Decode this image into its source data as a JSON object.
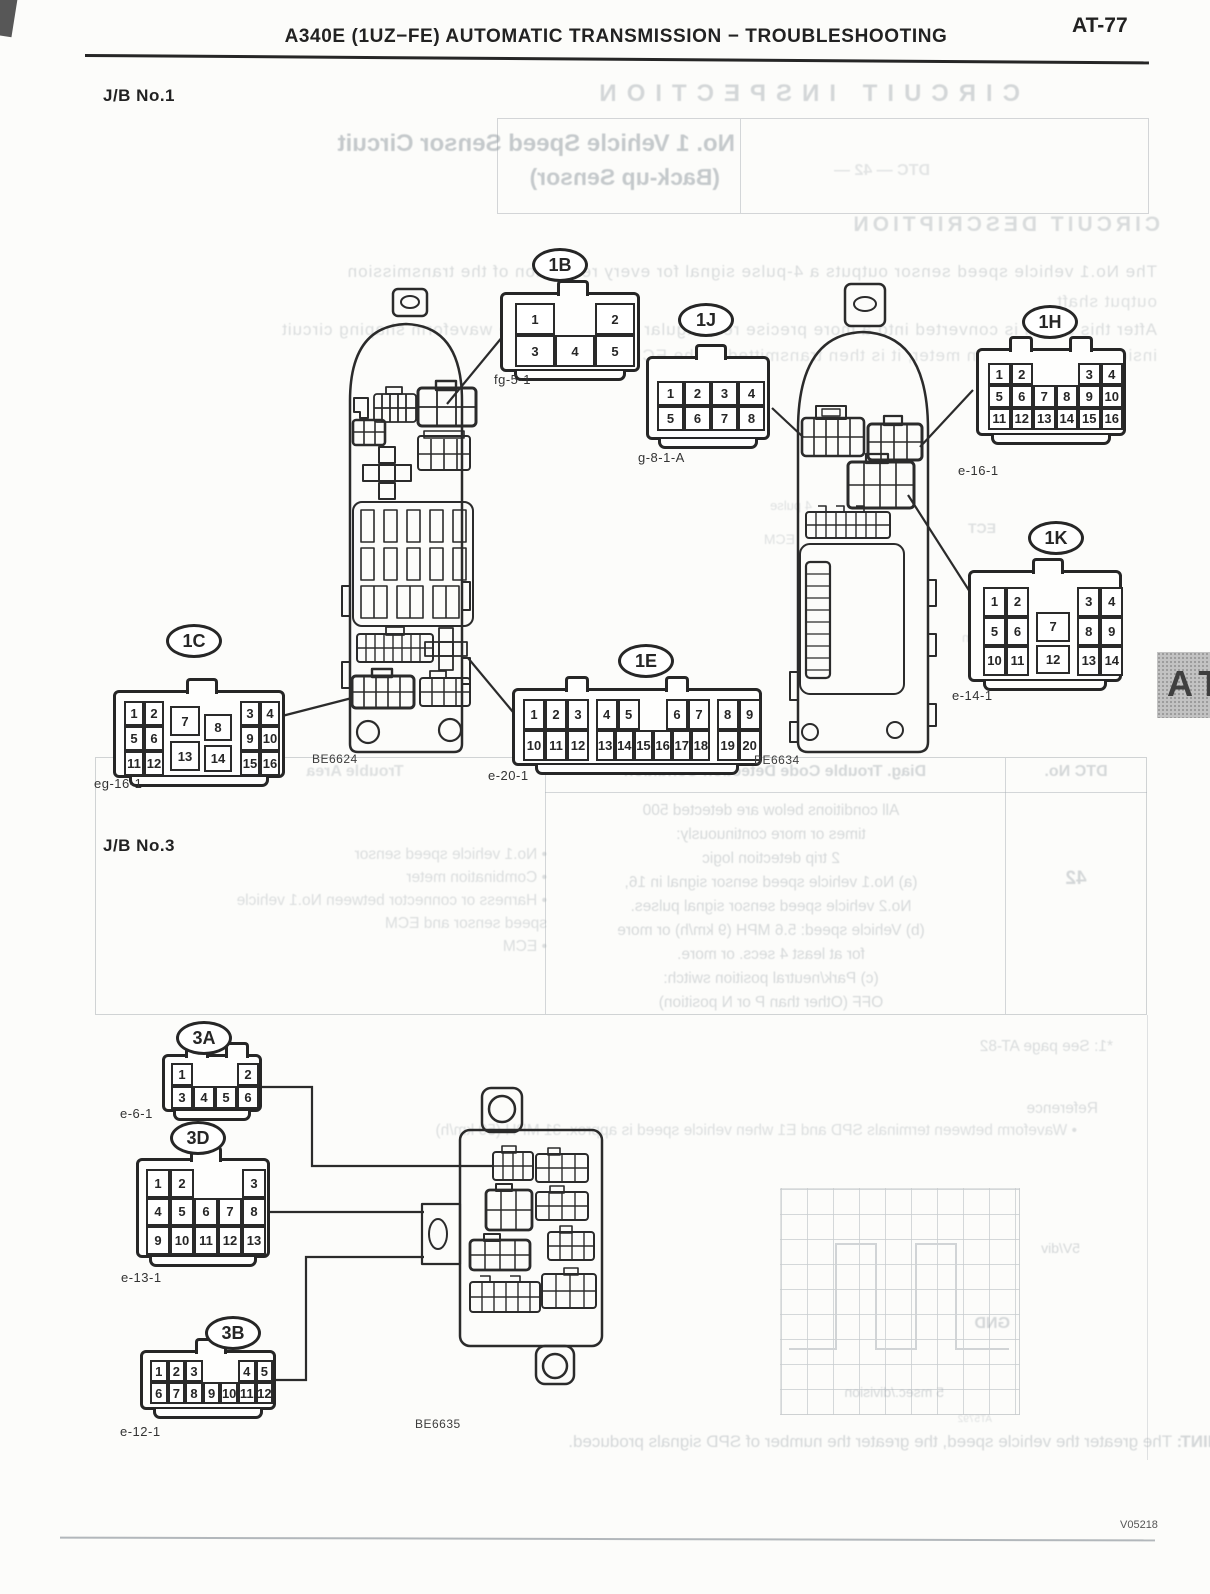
{
  "page": {
    "header_title": "A340E (1UZ−FE) AUTOMATIC TRANSMISSION − TROUBLESHOOTING",
    "page_number": "AT-77",
    "figure_code": "V05218",
    "side_tab": "AT"
  },
  "sections": {
    "jb1_heading": "J/B No.1",
    "jb3_heading": "J/B No.3"
  },
  "junction_blocks": [
    {
      "code": "BE6624"
    },
    {
      "code": "BE6634"
    },
    {
      "code": "BE6635"
    }
  ],
  "connectors": [
    {
      "id": "1B",
      "sublabel": "fg-5-1",
      "cells": [
        [
          "1",
          0,
          0
        ],
        [
          "2",
          2,
          0
        ],
        [
          "3",
          0,
          1
        ],
        [
          "4",
          1,
          1
        ],
        [
          "5",
          2,
          1
        ]
      ]
    },
    {
      "id": "1J",
      "sublabel": "g-8-1-A",
      "cells": [
        [
          "1",
          0,
          0
        ],
        [
          "2",
          1,
          0
        ],
        [
          "3",
          2,
          0
        ],
        [
          "4",
          3,
          0
        ],
        [
          "5",
          0,
          1
        ],
        [
          "6",
          1,
          1
        ],
        [
          "7",
          2,
          1
        ],
        [
          "8",
          3,
          1
        ]
      ]
    },
    {
      "id": "1H",
      "sublabel": "e-16-1",
      "cells": [
        [
          "1",
          0,
          0
        ],
        [
          "2",
          1,
          0
        ],
        [
          "3",
          4,
          0
        ],
        [
          "4",
          5,
          0
        ],
        [
          "5",
          0,
          1
        ],
        [
          "6",
          1,
          1
        ],
        [
          "7",
          2,
          1
        ],
        [
          "8",
          3,
          1
        ],
        [
          "9",
          4,
          1
        ],
        [
          "10",
          5,
          1
        ],
        [
          "11",
          0,
          2
        ],
        [
          "12",
          1,
          2
        ],
        [
          "13",
          2,
          2
        ],
        [
          "14",
          3,
          2
        ],
        [
          "15",
          4,
          2
        ],
        [
          "16",
          5,
          2
        ]
      ]
    },
    {
      "id": "1K",
      "sublabel": "e-14-1",
      "cells": [
        [
          "1",
          0,
          0
        ],
        [
          "2",
          1,
          0
        ],
        [
          "3",
          4.1,
          0
        ],
        [
          "4",
          5.1,
          0
        ],
        [
          "5",
          0,
          1
        ],
        [
          "6",
          1,
          1
        ],
        [
          "7",
          2.3,
          0.85,
          1.5
        ],
        [
          "8",
          4.1,
          1
        ],
        [
          "9",
          5.1,
          1
        ],
        [
          "10",
          0,
          2
        ],
        [
          "11",
          1,
          2
        ],
        [
          "12",
          2.3,
          1.95,
          1.5
        ],
        [
          "13",
          4.1,
          2
        ],
        [
          "14",
          5.1,
          2
        ]
      ]
    },
    {
      "id": "1C",
      "sublabel": "eg-16-1",
      "cells": [
        [
          "1",
          0,
          0
        ],
        [
          "2",
          1,
          0
        ],
        [
          "3",
          5.8,
          0
        ],
        [
          "4",
          6.8,
          0
        ],
        [
          "5",
          0,
          1
        ],
        [
          "6",
          1,
          1
        ],
        [
          "7",
          2.3,
          0.2,
          1.5,
          1.2
        ],
        [
          "8",
          4,
          0.5,
          1.4,
          1.1
        ],
        [
          "9",
          5.8,
          1
        ],
        [
          "10",
          6.8,
          1
        ],
        [
          "11",
          0,
          2
        ],
        [
          "12",
          1,
          2
        ],
        [
          "13",
          2.3,
          1.6,
          1.5,
          1.2
        ],
        [
          "14",
          4,
          1.75,
          1.4,
          1.1
        ],
        [
          "15",
          5.8,
          2
        ],
        [
          "16",
          6.8,
          2
        ]
      ]
    },
    {
      "id": "1E",
      "sublabel": "e-20-1",
      "cells": [
        [
          "1",
          0,
          0
        ],
        [
          "2",
          1,
          0
        ],
        [
          "3",
          2,
          0
        ],
        [
          "4",
          3.3,
          0
        ],
        [
          "5",
          4.3,
          0
        ],
        [
          "6",
          6.5,
          0
        ],
        [
          "7",
          7.5,
          0
        ],
        [
          "8",
          8.8,
          0
        ],
        [
          "9",
          9.8,
          0
        ],
        [
          "10",
          0,
          1
        ],
        [
          "11",
          1,
          1
        ],
        [
          "12",
          2,
          1
        ],
        [
          "13",
          3.3,
          1,
          0.87
        ],
        [
          "14",
          4.17,
          1,
          0.87
        ],
        [
          "15",
          5.04,
          1,
          0.87
        ],
        [
          "16",
          5.91,
          1,
          0.87
        ],
        [
          "17",
          6.78,
          1,
          0.87
        ],
        [
          "18",
          7.65,
          1,
          0.87
        ],
        [
          "19",
          8.8,
          1
        ],
        [
          "20",
          9.8,
          1
        ]
      ]
    },
    {
      "id": "3A",
      "sublabel": "e-6-1",
      "cells": [
        [
          "1",
          0,
          0
        ],
        [
          "2",
          3,
          0
        ],
        [
          "3",
          0,
          1
        ],
        [
          "4",
          1,
          1
        ],
        [
          "5",
          2,
          1
        ],
        [
          "6",
          3,
          1
        ]
      ]
    },
    {
      "id": "3D",
      "sublabel": "e-13-1",
      "cells": [
        [
          "1",
          0,
          0
        ],
        [
          "2",
          1,
          0
        ],
        [
          "3",
          4,
          0
        ],
        [
          "4",
          0,
          1
        ],
        [
          "5",
          1,
          1
        ],
        [
          "6",
          2,
          1
        ],
        [
          "7",
          3,
          1
        ],
        [
          "8",
          4,
          1
        ],
        [
          "9",
          0,
          2
        ],
        [
          "10",
          1,
          2
        ],
        [
          "11",
          2,
          2
        ],
        [
          "12",
          3,
          2
        ],
        [
          "13",
          4,
          2
        ]
      ]
    },
    {
      "id": "3B",
      "sublabel": "e-12-1",
      "cells": [
        [
          "1",
          0,
          0
        ],
        [
          "2",
          1,
          0
        ],
        [
          "3",
          2,
          0
        ],
        [
          "4",
          5,
          0
        ],
        [
          "5",
          6,
          0
        ],
        [
          "6",
          0,
          1
        ],
        [
          "7",
          1,
          1
        ],
        [
          "8",
          2,
          1
        ],
        [
          "9",
          3,
          1
        ],
        [
          "10",
          4,
          1
        ],
        [
          "11",
          5,
          1
        ],
        [
          "12",
          6,
          1
        ]
      ]
    }
  ],
  "bleedthrough": {
    "circuit_inspection": "CIRCUIT INSPECTION",
    "title_line1": "No. 1 Vehicle Speed Sensor Circuit",
    "title_line2": "(Back-up Sensor)",
    "dtc_fragment": "DTC — 42 —",
    "circuit_description": "CIRCUIT DESCRIPTION",
    "desc_lines": [
      "The No.1 vehicle speed sensor outputs a 4-pulse signal for every revolution of the transmission",
      "output shaft.",
      "After this signal is converted into a more precise rectangular waveform by the waveform shaping circuit",
      "inside the combination meter, it is then transmitted to the ECM."
    ],
    "table_header_area": "Trouble Area",
    "table_header_condition": "Diag. Trouble Code Detection Condition",
    "table_header_dtc": "DTC No.",
    "table_dtc_value": "42",
    "cond_lines": [
      "All conditions below are detected 500",
      "times or more continuously:",
      "2 trip detection logic",
      "(a)  No.1 vehicle speed sensor signal in 16,",
      "No.2 vehicle speed sensor signal pulses.",
      "(b)  Vehicle speed:  5.6 MPH (9 km/h) or more",
      "for at least 4 secs. or more.",
      "(c)  Park/neutral position switch:",
      "OFF (Other than P or N position)"
    ],
    "area_lines": [
      "• No.1 vehicle speed sensor",
      "• Combination meter",
      "• Harness or connector between No.1 vehicle",
      "speed sensor and ECM",
      "• ECM"
    ],
    "see_page": "*1: See page AT-82",
    "reference": "Reference",
    "waveform_note": "• Waveform between terminals SPD and E1 when vehicle speed is approx. 31 MPH (50 km/h)",
    "scope_vdiv": "5V/div",
    "scope_gnd": "GND",
    "scope_time": "5 msec./division",
    "scope_code": "AT5792",
    "hint_label": "HINT:",
    "hint_text": "The greater the vehicle speed, the greater the number of SPD signals produced.",
    "frag_4pulse": "4 pulse",
    "frag_ecm": "ECM",
    "frag_ect": "ECT",
    "frag_combination": "Combination",
    "frag_meter": "Meter"
  }
}
